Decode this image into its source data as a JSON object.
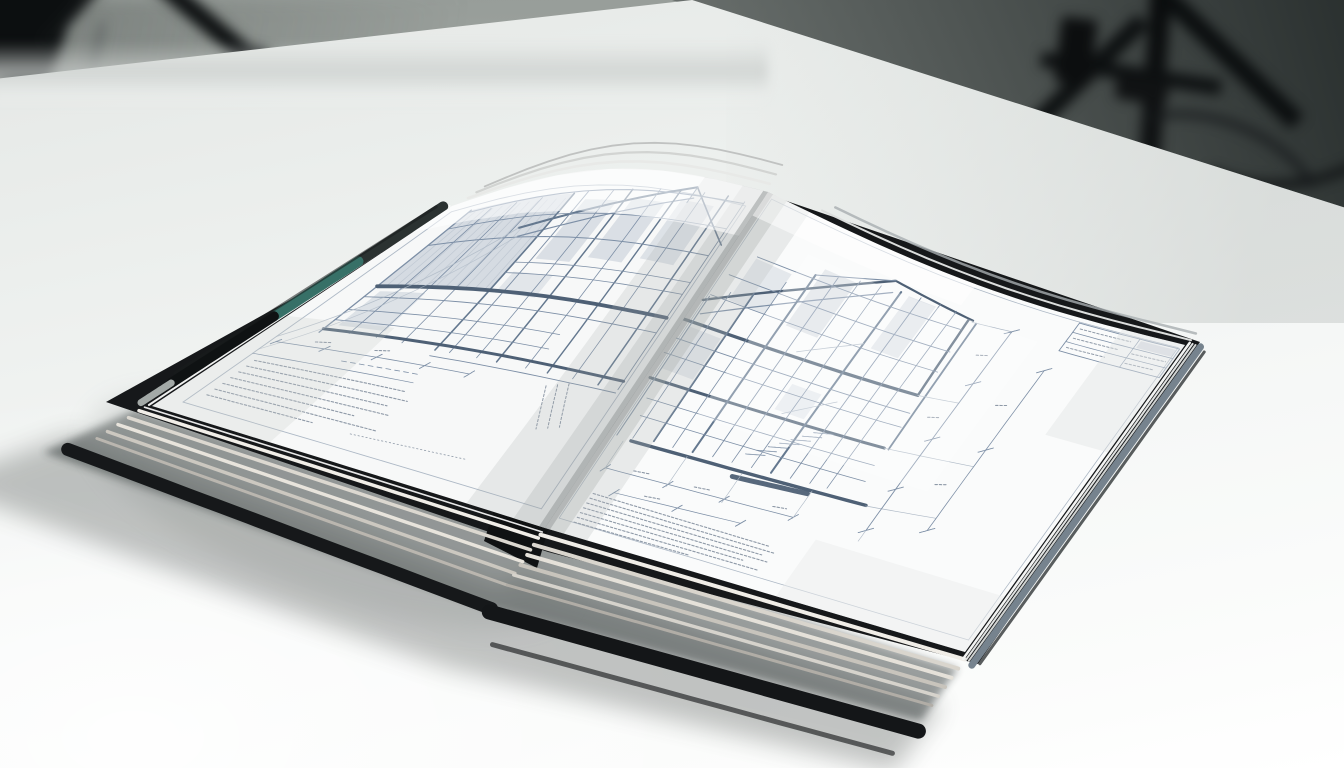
{
  "scene": {
    "description": "Studio photograph of an open hardcover architecture book with blueprint-style building elevation drawings, lying on a bright white table; blurred black tripod light stands against a gray backdrop",
    "objects": {
      "book": "open hardcover book of architectural blueprint drawings",
      "table": "white studio table",
      "background": "gray photo-studio backdrop with blurred tripod light stands"
    }
  },
  "book": {
    "left_page": {
      "description": "Blueprint elevation drawing of a building facade with shaded glazing panels, gable roof slope, dimension strings and an illegible fine-print notes block",
      "text_legible": false
    },
    "right_page": {
      "description": "Blueprint section drawing of a two-storey structure with stair detail, vertical and horizontal dimension lines with tick marks, an illegible specification paragraph and a small title block",
      "text_legible": false
    },
    "cover_color": "#16181a",
    "accent_stripe_color": "#377067",
    "page_color": "#f7f8f8",
    "page_color_right": "#fafbfb",
    "page_edge_color": "#ddd9d1",
    "spine_edge_color": "#76838e"
  },
  "palette": {
    "backdrop_top": "#969c98",
    "backdrop_bottom": "#f2f4f3",
    "backdrop_dark_corner": "#2b3130",
    "table_surface": "#f5f7f6",
    "shadow": "#3c4341",
    "blueprint_line": "#7d8fa6",
    "blueprint_line_medium": "#64788f",
    "blueprint_line_heavy": "#4e6075",
    "blueprint_line_faint": "#aeb9c6",
    "blueprint_text": "#8e99a7",
    "blueprint_panel": "#b3bdcb"
  }
}
